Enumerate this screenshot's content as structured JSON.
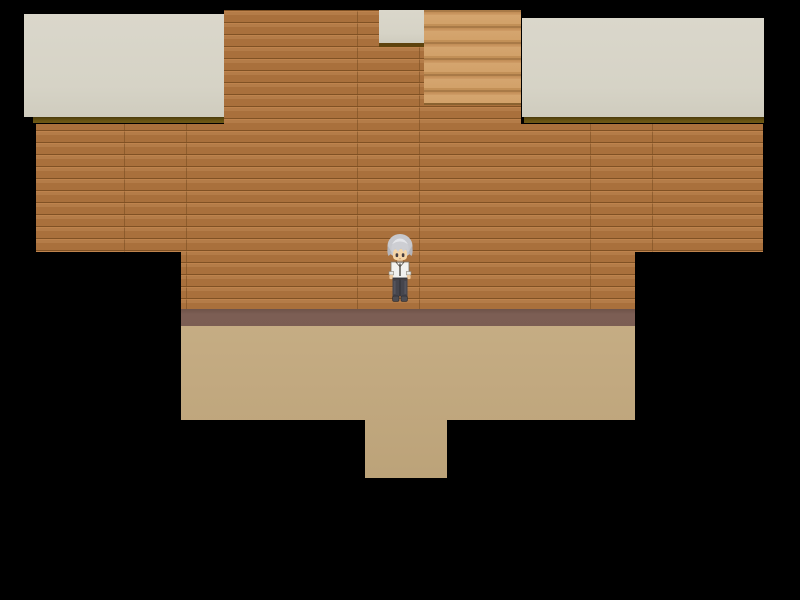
{
  "scene": {
    "description": "Top-down 16-bit RPG room interior: wooden plank walls, beige ceiling panels, a staircase opening at the top, mauve baseboard and tan floor with an exit corridor at the bottom, surrounded by black void",
    "style": "RPG Maker style game screen",
    "viewport_px": {
      "width": 800,
      "height": 600
    }
  },
  "palette": {
    "background": "#000000",
    "ceiling_panel": "#d6d3c6",
    "ceiling_shadow_line": "#63500f",
    "wall_plank": "#b0753e",
    "wall_seam": "#7d4f22",
    "stairs_light": "#d2a169",
    "stairs_shadow": "#a97a47",
    "baseboard": "#7b5d53",
    "floor": "#c2a87d"
  },
  "entities": {
    "player": {
      "name": "player-character",
      "label": "Player character",
      "facing": "down",
      "hair_color": "#c9cacf",
      "skin_color": "#f4d5a7",
      "shirt_color": "#f2f2ef",
      "pants_color": "#45454d",
      "position_px": {
        "x": 384,
        "y": 232
      },
      "size_px": {
        "width": 32,
        "height": 72
      }
    }
  },
  "map_features": {
    "staircase": "stairs leading up, top of room",
    "floor_exit": "corridor opening at bottom center of floor",
    "ceiling_panels": [
      "left panel",
      "right panel",
      "small panel above stairs"
    ]
  }
}
